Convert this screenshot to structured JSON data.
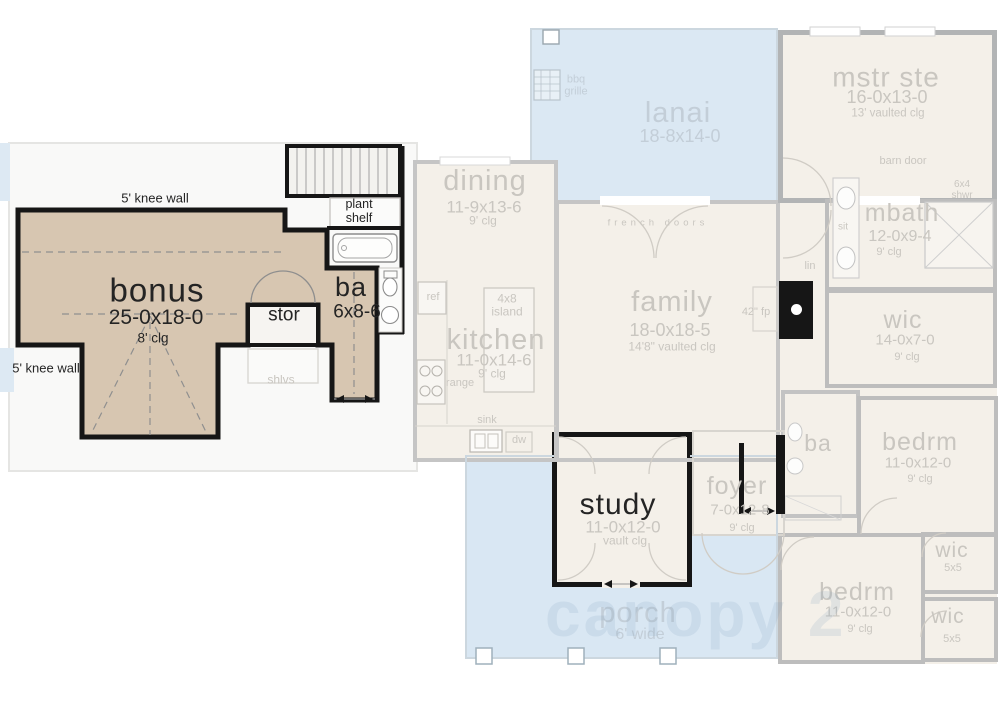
{
  "colors": {
    "tan_highlight": "#d7c6b1",
    "beige_floor": "#f4f0e9",
    "blue_outdoor": "#dbe8f3",
    "black_wall": "#161616",
    "faded_wall": "#c5c5c5",
    "faded_text": "#c9c6c0"
  },
  "upper_floor": {
    "knee_wall_top": "5' knee wall",
    "knee_wall_left": "5' knee wall",
    "bonus": {
      "name": "bonus",
      "dims": "25-0x18-0",
      "clg": "8' clg"
    },
    "stor_label": "stor",
    "shlvs_label": "shlvs",
    "plant_shelf_line1": "plant",
    "plant_shelf_line2": "shelf",
    "ba": {
      "name": "ba",
      "dims": "6x8-6"
    }
  },
  "main_floor": {
    "dining": {
      "name": "dining",
      "dims": "11-9x13-6",
      "clg": "9' clg"
    },
    "kitchen": {
      "name": "kitchen",
      "dims": "11-0x14-6",
      "clg": "9' clg"
    },
    "island_line1": "4x8",
    "island_line2": "island",
    "ref": "ref",
    "range": "range",
    "sink": "sink",
    "dw": "dw",
    "lanai": {
      "name": "lanai",
      "dims": "18-8x14-0"
    },
    "bbq_line1": "bbq",
    "bbq_line2": "grille",
    "french_doors": "french doors",
    "family": {
      "name": "family",
      "dims": "18-0x18-5",
      "clg": "14'8\" vaulted clg"
    },
    "fireplace": "42\" fp",
    "lin": "lin",
    "mstr": {
      "name": "mstr ste",
      "dims": "16-0x13-0",
      "clg": "13' vaulted clg"
    },
    "barn_door": "barn door",
    "shwr_line1": "6x4",
    "shwr_line2": "shwr",
    "sit": "sit",
    "mbath": {
      "name": "mbath",
      "dims": "12-0x9-4",
      "clg": "9' clg"
    },
    "wic_hall": {
      "name": "wic",
      "dims": "14-0x7-0",
      "clg": "9' clg"
    },
    "ba2": "ba",
    "bedrm_right": {
      "name": "bedrm",
      "dims": "11-0x12-0",
      "clg": "9' clg"
    },
    "wic_small_1": {
      "name": "wic",
      "dims": "5x5"
    },
    "wic_small_2": {
      "name": "wic",
      "dims": "5x5"
    },
    "bedrm_bottom": {
      "name": "bedrm",
      "dims": "11-0x12-0",
      "clg": "9' clg"
    },
    "study": {
      "name": "study",
      "dims": "11-0x12-0",
      "clg": "vault clg"
    },
    "foyer": {
      "name": "foyer",
      "dims": "7-0x12-8",
      "clg": "9' clg"
    },
    "porch": {
      "name": "porch",
      "dims": "6' wide"
    }
  },
  "watermark": "canopy 2"
}
